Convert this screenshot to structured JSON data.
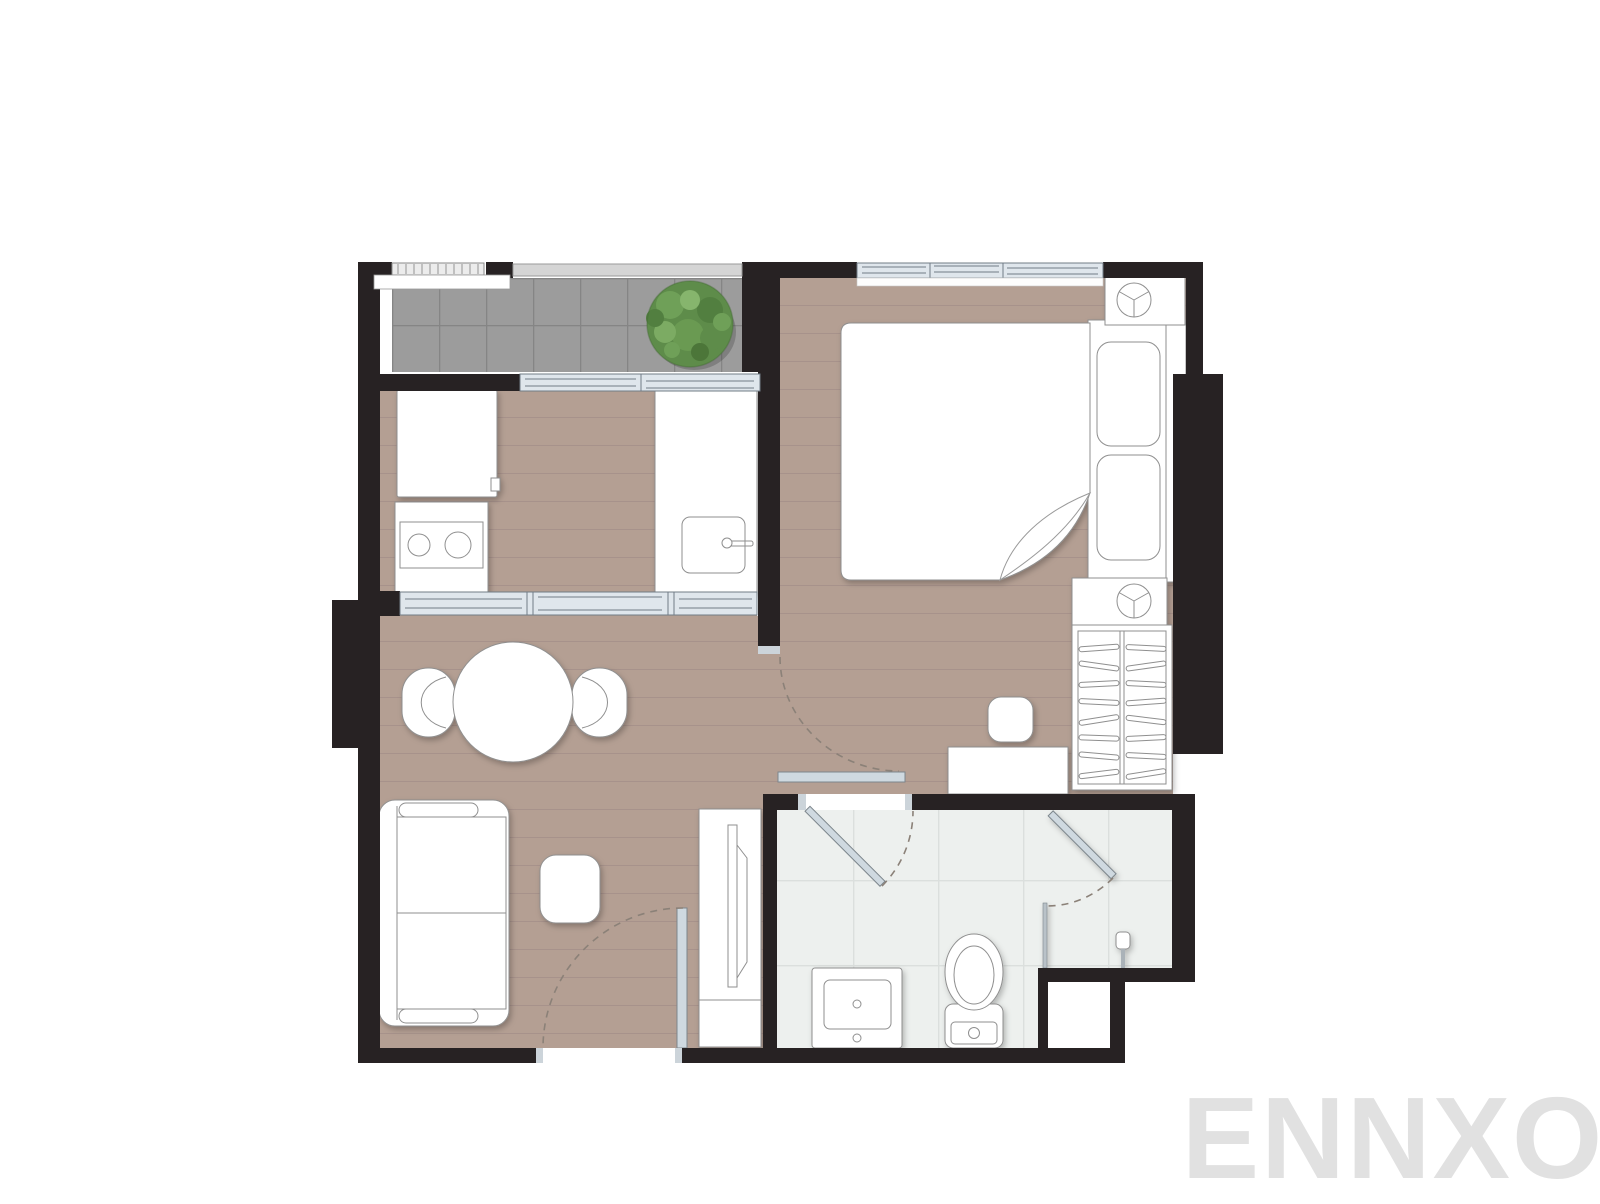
{
  "watermark": {
    "text": "ENNXO"
  },
  "plan": {
    "type": "one-bedroom condominium floor plan",
    "rooms": [
      {
        "name": "balcony",
        "floor": "grey tile",
        "items": [
          "potted plant",
          "railing",
          "sliding glass door to kitchen"
        ]
      },
      {
        "name": "bedroom",
        "floor": "wood plank",
        "items": [
          "double bed with folded blanket",
          "two pillows",
          "nightstand with ceiling lamp symbol (top)",
          "nightstand with ceiling lamp symbol (bottom)",
          "wardrobe with clothes hangers",
          "desk",
          "stool",
          "sliding window",
          "sliding door to living area"
        ]
      },
      {
        "name": "kitchen",
        "floor": "wood plank",
        "items": [
          "refrigerator",
          "counter with two-burner stove",
          "counter with sink and faucet",
          "three-panel sliding glass partition to dining area"
        ]
      },
      {
        "name": "living-dining",
        "floor": "wood plank",
        "items": [
          "round dining table",
          "two dining chairs",
          "two-seat sofa",
          "coffee table",
          "TV cabinet with television",
          "entrance door with swing arc"
        ]
      },
      {
        "name": "bathroom",
        "floor": "light tile",
        "items": [
          "vanity sink",
          "toilet",
          "glass shower door",
          "glass shower partition",
          "shower head",
          "hinged entry door with swing arc"
        ]
      }
    ]
  },
  "colors": {
    "background": "#ffffff",
    "wall": "#272223",
    "end_cap": "#ccd4da",
    "wood_floor": "#b49f93",
    "wood_plank_line": "#a5908a",
    "balcony_tile": "#9c9c9c",
    "balcony_tile_line": "#858585",
    "bath_tile": "#edf0ee",
    "bath_tile_line": "#dbdfdd",
    "glass_fill": "#dfe6ec",
    "glass_stroke": "#707c86",
    "door_leaf": "#cfd9e0",
    "railing": "#d5d5d5",
    "furniture_fill": "#ffffff",
    "furniture_stroke": "#8f8f8f",
    "dashed_arc": "#8b8178",
    "plant_green": "#5e8c4a",
    "plant_green_light": "#86b56d",
    "plant_green_dark": "#4c7639",
    "watermark": "#e1e1e1"
  }
}
